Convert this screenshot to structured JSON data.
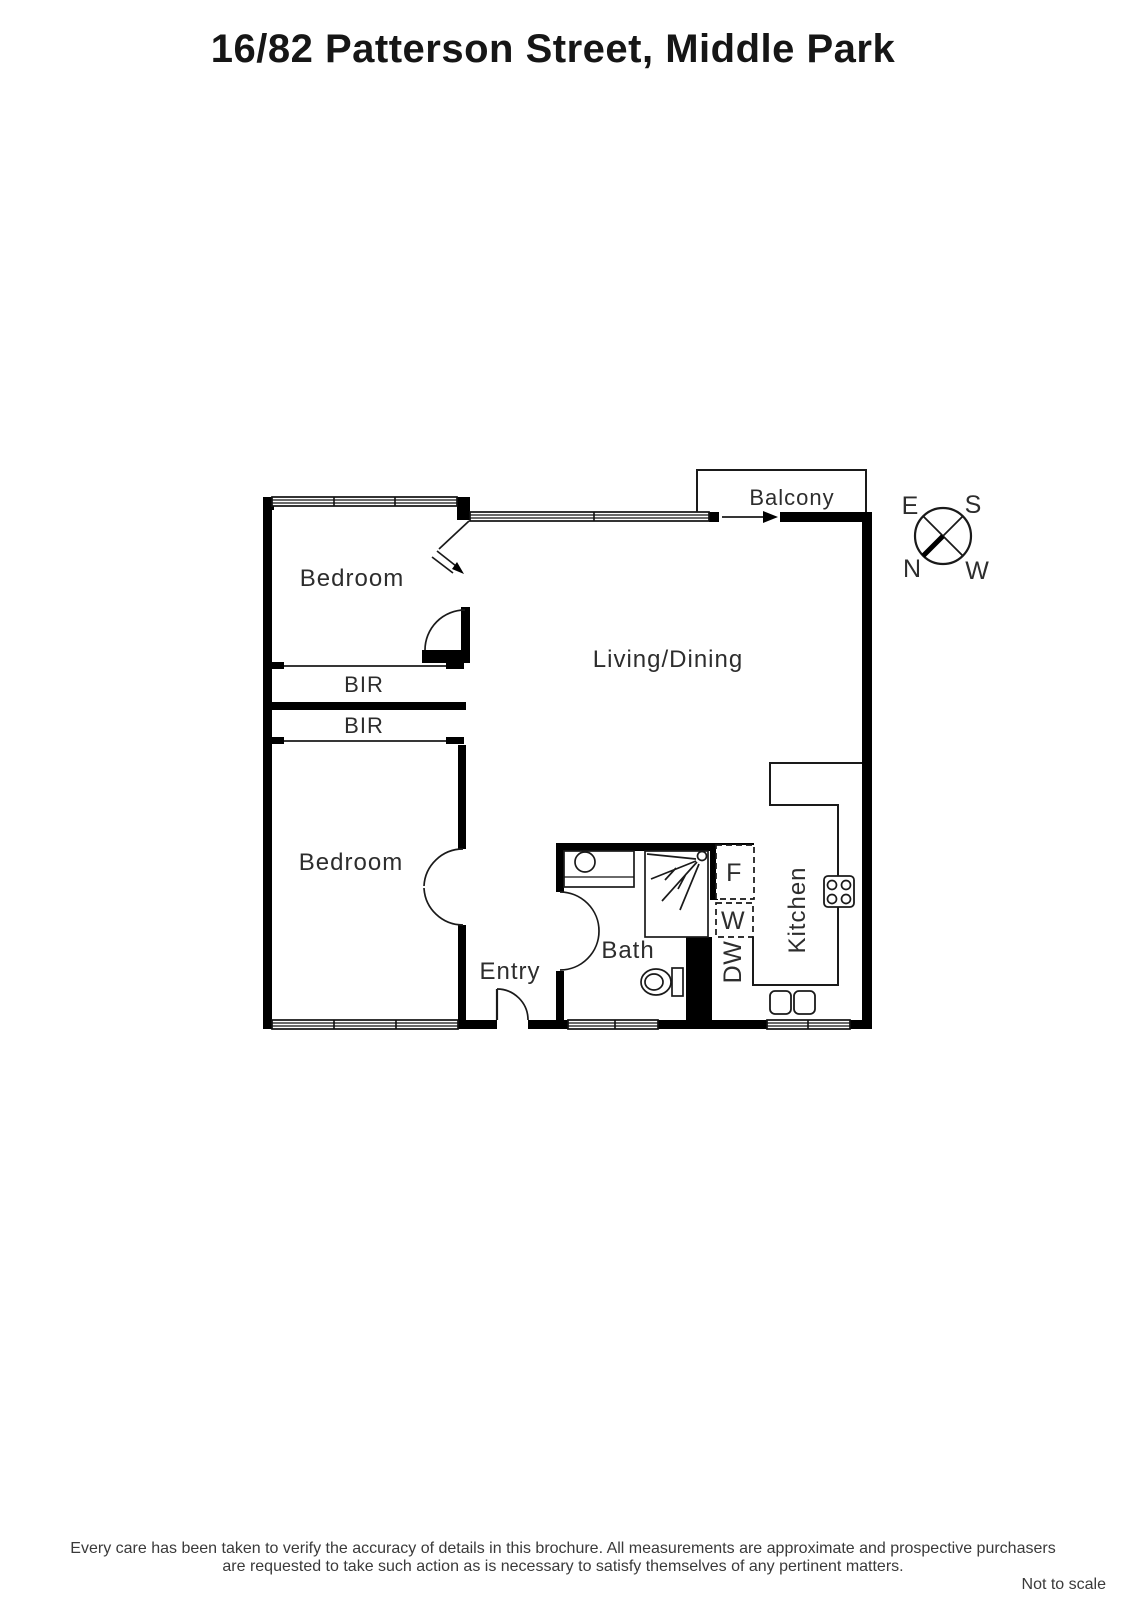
{
  "title": "16/82 Patterson Street, Middle Park",
  "plan": {
    "rooms": {
      "bedroom_top": "Bedroom",
      "bedroom_bottom": "Bedroom",
      "living_dining": "Living/Dining",
      "balcony": "Balcony",
      "kitchen": "Kitchen",
      "bath": "Bath",
      "entry": "Entry",
      "bir_top": "BIR",
      "bir_bottom": "BIR"
    },
    "appliances": {
      "fridge": "F",
      "washer": "W",
      "dishwasher": "DW"
    },
    "compass": {
      "top_left": "E",
      "top_right": "S",
      "bottom_left": "N",
      "bottom_right": "W"
    }
  },
  "footer": {
    "disclaimer_line1": "Every care has been taken to verify the accuracy of details in this brochure.  All measurements are approximate and prospective purchasers",
    "disclaimer_line2": "are requested to take such action as is necessary to satisfy themselves of any pertinent matters.",
    "scale_note": "Not to scale"
  },
  "colors": {
    "wall": "#000000",
    "text": "#2d2d2d",
    "background": "#ffffff"
  }
}
